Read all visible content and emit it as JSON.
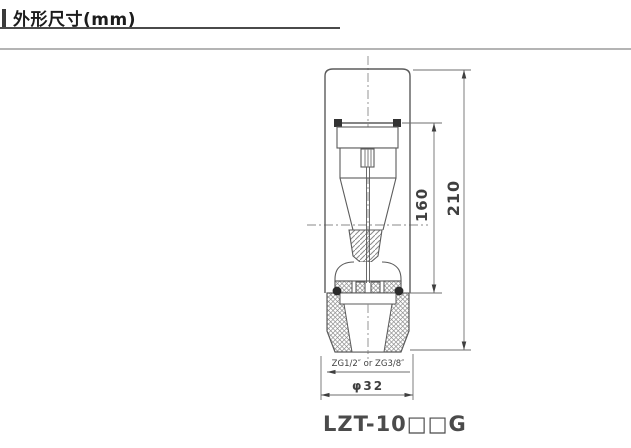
{
  "header": {
    "title": "外形尺寸(mm)"
  },
  "drawing": {
    "type": "technical-outline-dimension-diagram",
    "component": "glass-tube-flowmeter",
    "dimensions": {
      "tube_height": "160",
      "total_height": "210",
      "thread_note": "ZG1/2″ or ZG3/8″",
      "base_diameter": "φ32"
    },
    "model": {
      "label": "LZT-10□□G"
    }
  },
  "colors": {
    "outline": "#5b5b5b",
    "dimension_line": "#6e6e6e",
    "centerline": "#8a8a8a",
    "accent_dark": "#3a3a3a",
    "rule_gray": "#b4b4b4"
  }
}
